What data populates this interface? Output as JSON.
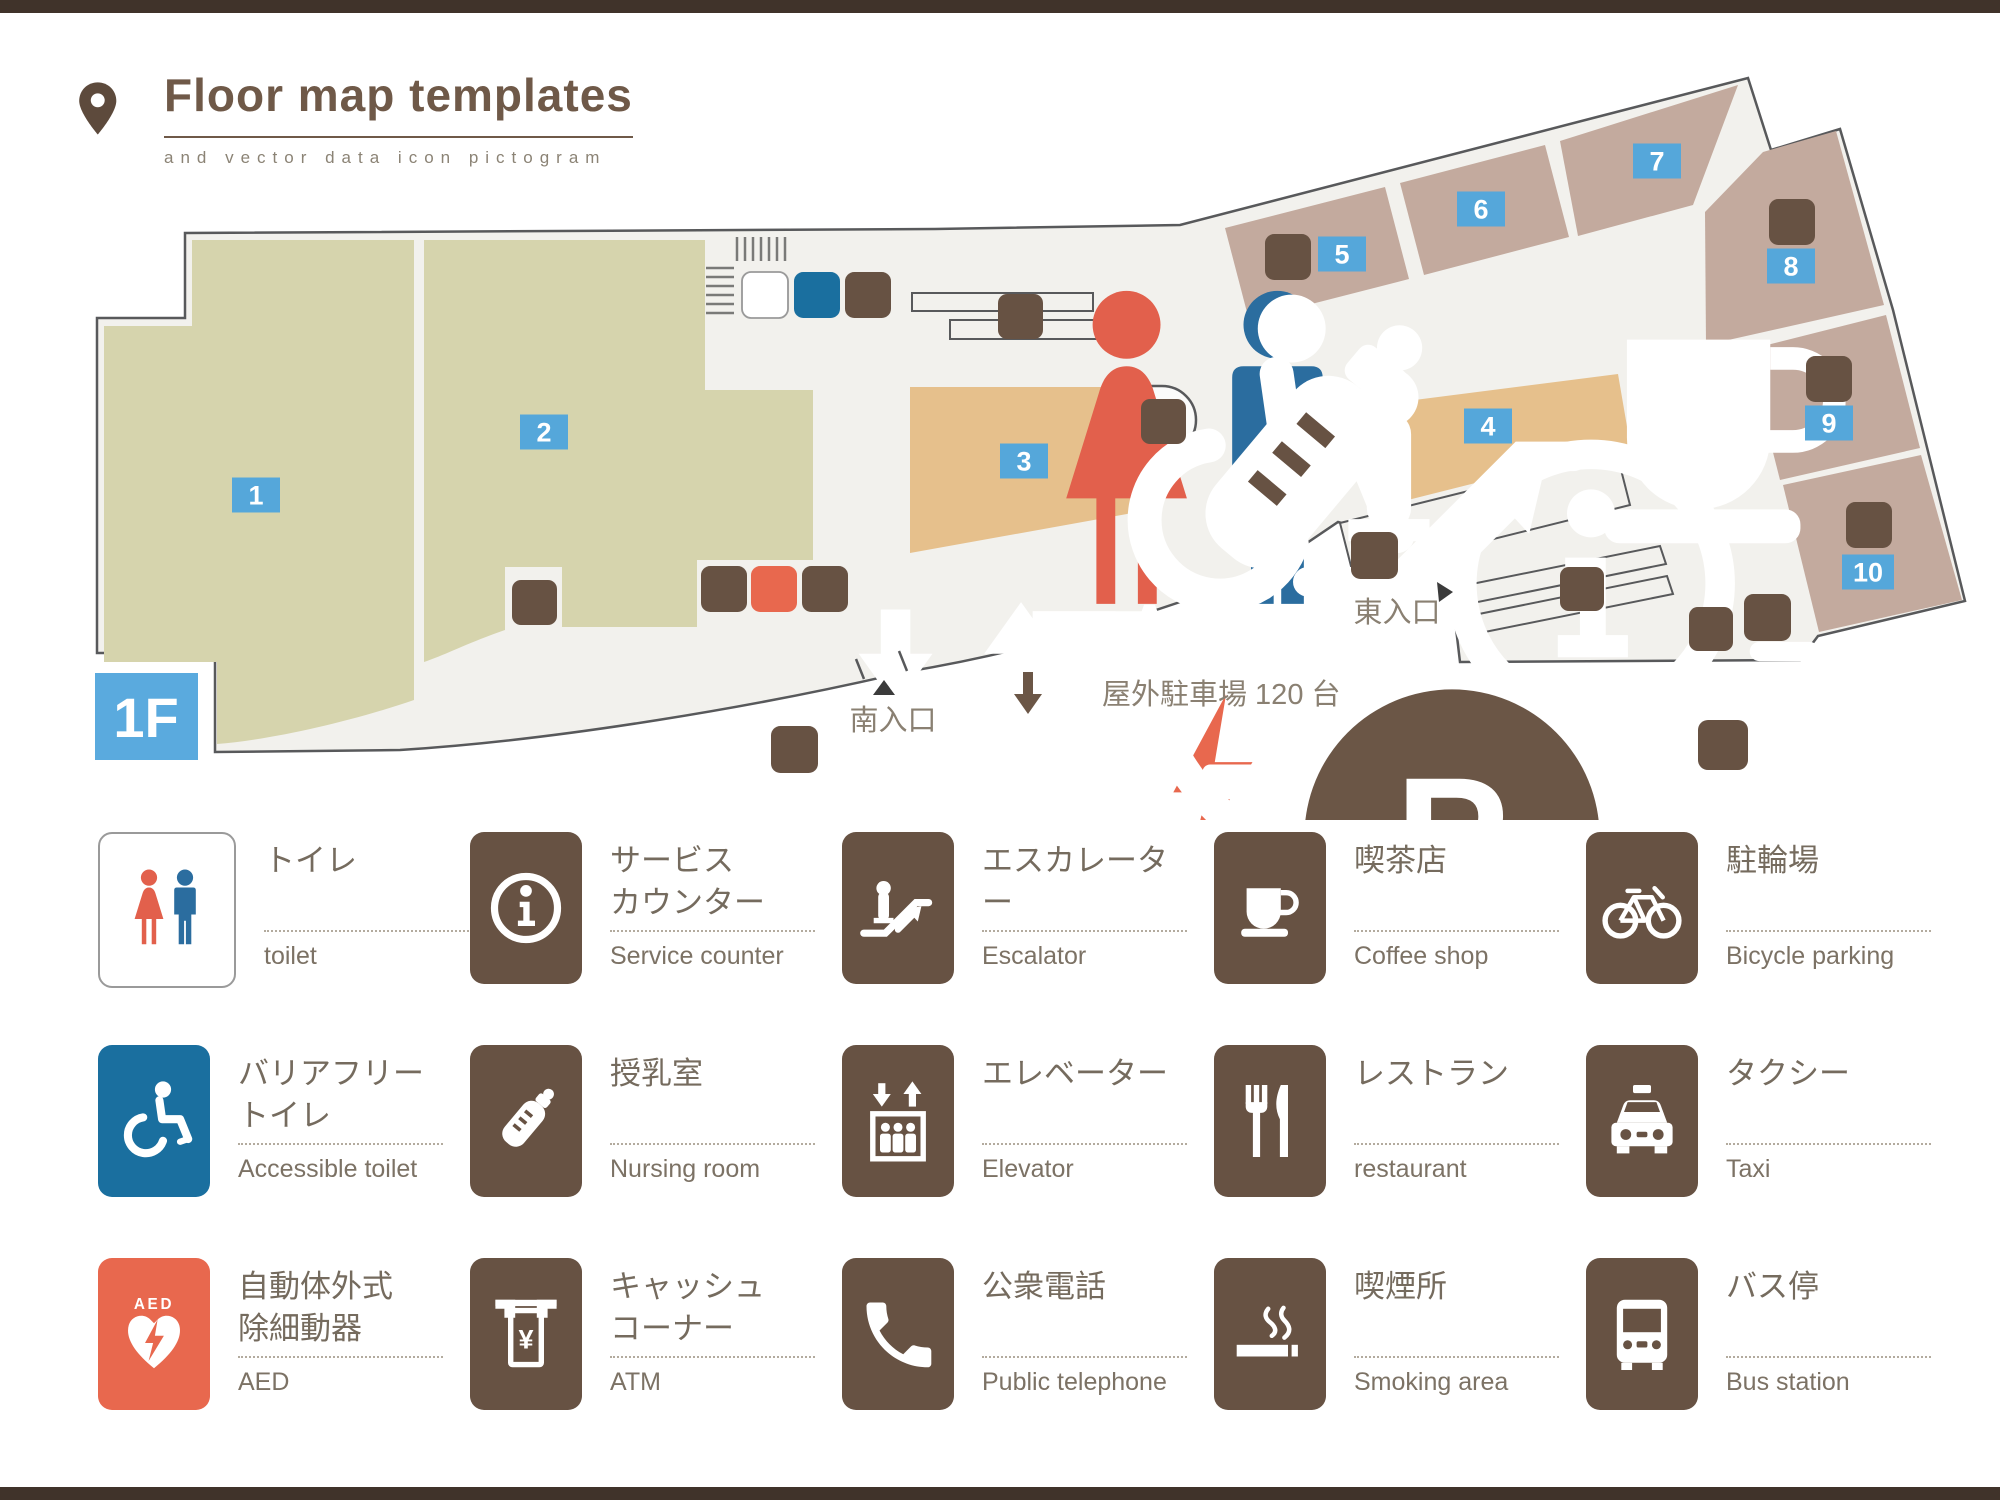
{
  "header": {
    "title": "Floor map templates",
    "subtitle": "and vector data icon pictogram",
    "pin_icon": "location-pin"
  },
  "map": {
    "floor_label": "1F",
    "south_entrance_label": "南入口",
    "east_entrance_label": "東入口",
    "parking_label": "屋外駐車場 120 台",
    "areas": [
      {
        "no": "1",
        "zone": "green"
      },
      {
        "no": "2",
        "zone": "green"
      },
      {
        "no": "3",
        "zone": "tan"
      },
      {
        "no": "4",
        "zone": "tan"
      },
      {
        "no": "5",
        "zone": "shop"
      },
      {
        "no": "6",
        "zone": "shop"
      },
      {
        "no": "7",
        "zone": "shop"
      },
      {
        "no": "8",
        "zone": "shop"
      },
      {
        "no": "9",
        "zone": "shop"
      },
      {
        "no": "10",
        "zone": "shop"
      }
    ],
    "facility_icons": [
      "toilet",
      "accessible-toilet",
      "nursing-room",
      "escalator",
      "service-counter",
      "coffee-shop",
      "restaurant",
      "elevator",
      "atm",
      "aed",
      "public-telephone",
      "bicycle-parking",
      "smoking-area",
      "bus-station",
      "taxi",
      "parking",
      "down-arrow"
    ],
    "colors": {
      "floor": "#f2f1ed",
      "outline": "#58595b",
      "room_green": "#d6d4ad",
      "area_tan": "#e6c08c",
      "shop_mauve": "#c3aa9e",
      "badge_blue": "#55a7da",
      "floor_badge_blue": "#5aaade",
      "icon_brown": "#675243",
      "aed_red": "#e8684e",
      "accessible_blue": "#1a6f9f"
    }
  },
  "legend": {
    "items": [
      {
        "jp1": "トイレ",
        "jp2": "",
        "en": "toilet",
        "icon": "toilet"
      },
      {
        "jp1": "サービス",
        "jp2": "カウンター",
        "en": "Service counter",
        "icon": "service-counter"
      },
      {
        "jp1": "エスカレーター",
        "jp2": "",
        "en": "Escalator",
        "icon": "escalator"
      },
      {
        "jp1": "喫茶店",
        "jp2": "",
        "en": "Coffee shop",
        "icon": "coffee-shop"
      },
      {
        "jp1": "駐輪場",
        "jp2": "",
        "en": "Bicycle parking",
        "icon": "bicycle-parking"
      },
      {
        "jp1": "バリアフリー",
        "jp2": "トイレ",
        "en": "Accessible toilet",
        "icon": "accessible-toilet"
      },
      {
        "jp1": "授乳室",
        "jp2": "",
        "en": "Nursing room",
        "icon": "nursing-room"
      },
      {
        "jp1": "エレベーター",
        "jp2": "",
        "en": "Elevator",
        "icon": "elevator"
      },
      {
        "jp1": "レストラン",
        "jp2": "",
        "en": "restaurant",
        "icon": "restaurant"
      },
      {
        "jp1": "タクシー",
        "jp2": "",
        "en": "Taxi",
        "icon": "taxi"
      },
      {
        "jp1": "自動体外式",
        "jp2": "除細動器",
        "en": "AED",
        "icon": "aed"
      },
      {
        "jp1": "キャッシュ",
        "jp2": "コーナー",
        "en": "ATM",
        "icon": "atm"
      },
      {
        "jp1": "公衆電話",
        "jp2": "",
        "en": "Public telephone",
        "icon": "public-telephone"
      },
      {
        "jp1": "喫煙所",
        "jp2": "",
        "en": "Smoking area",
        "icon": "smoking-area"
      },
      {
        "jp1": "バス停",
        "jp2": "",
        "en": "Bus station",
        "icon": "bus-station"
      }
    ]
  }
}
